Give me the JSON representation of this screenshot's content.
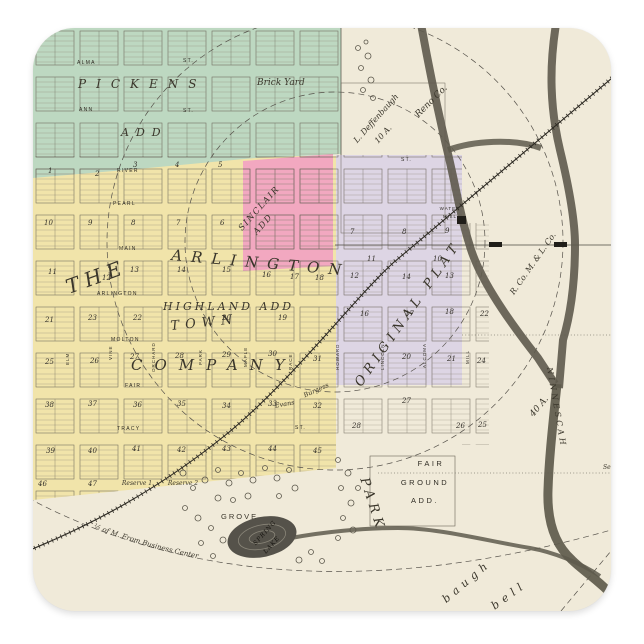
{
  "product": {
    "description_label": "square sticker with vintage town plat map"
  },
  "palette": {
    "paper": "#f0ead9",
    "green_addition": "#bdd8c1",
    "yellow_addition": "#f1e4aa",
    "pink_addition": "#f2a8c0",
    "lavender_addition": "#ddd5e4",
    "river": "#5e5a4c",
    "ink": "#3a362b",
    "page_background": "#ffffff"
  },
  "map": {
    "additions": {
      "pickens": "PICKENS",
      "pickens_add": "ADD",
      "sinclair": "SINCLAIR",
      "sinclair_add": "ADD",
      "original_plat": "ORIGINAL PLAT",
      "the": "THE",
      "arlington": "ARLINGTON",
      "town": "TOWN",
      "company": "COMPANY",
      "highland_add": "HIGHLAND ADD",
      "fair": "FAIR",
      "ground": "GROUND",
      "add": "ADD.",
      "park": "PARK"
    },
    "streets": {
      "alma": "ALMA",
      "ann": "ANN",
      "st": "ST.",
      "river": "RIVER",
      "pearl": "PEARL",
      "main": "MAIN",
      "arlington": "ARLINGTON",
      "molton": "MOLTON",
      "fair": "FAIR",
      "tracy": "TRACY",
      "elm": "ELM",
      "vine": "VINE",
      "orchard": "ORCHARD",
      "park": "PARK",
      "maple": "MAPLE",
      "race": "RACE",
      "howard": "HOWARD",
      "lincoln": "LINCOLN",
      "alcoma": "ALCOMA",
      "mill": "MILL"
    },
    "features": {
      "brick_yard": "Brick Yard",
      "water": "WATER",
      "mill": "MILL",
      "spring": "SPRING",
      "lake": "LAKE",
      "grove": "GROVE",
      "reserve1": "Reserve 1",
      "reserve2": "Reserve 2",
      "deffenbaugh": "L. Deffenbaugh",
      "ten_acres": "10 A.",
      "forty_acres": "40 A.",
      "reno_co": "Reno Co.",
      "mill_co": "R. Co. M. & L. Co.",
      "ninnescah": "NINNESCAH",
      "half_mile": "½ of M. From Business Center",
      "burgess": "Burgess",
      "evans": "Evans",
      "baugh": "baugh",
      "bell": "bell",
      "sec": "Sec."
    },
    "blocks": [
      {
        "n": "1",
        "x": 15,
        "y": 145
      },
      {
        "n": "2",
        "x": 62,
        "y": 148
      },
      {
        "n": "3",
        "x": 100,
        "y": 139
      },
      {
        "n": "4",
        "x": 142,
        "y": 139
      },
      {
        "n": "5",
        "x": 185,
        "y": 139
      },
      {
        "n": "10",
        "x": 11,
        "y": 197
      },
      {
        "n": "9",
        "x": 55,
        "y": 197
      },
      {
        "n": "8",
        "x": 98,
        "y": 197
      },
      {
        "n": "7",
        "x": 143,
        "y": 197
      },
      {
        "n": "6",
        "x": 187,
        "y": 197
      },
      {
        "n": "11",
        "x": 15,
        "y": 246
      },
      {
        "n": "12",
        "x": 69,
        "y": 252
      },
      {
        "n": "13",
        "x": 97,
        "y": 244
      },
      {
        "n": "14",
        "x": 144,
        "y": 244
      },
      {
        "n": "15",
        "x": 189,
        "y": 244
      },
      {
        "n": "16",
        "x": 229,
        "y": 249
      },
      {
        "n": "17",
        "x": 257,
        "y": 251
      },
      {
        "n": "18",
        "x": 282,
        "y": 252
      },
      {
        "n": "21",
        "x": 12,
        "y": 294
      },
      {
        "n": "23",
        "x": 55,
        "y": 292
      },
      {
        "n": "22",
        "x": 100,
        "y": 292
      },
      {
        "n": "20",
        "x": 189,
        "y": 292
      },
      {
        "n": "19",
        "x": 245,
        "y": 292
      },
      {
        "n": "25",
        "x": 12,
        "y": 336
      },
      {
        "n": "26",
        "x": 57,
        "y": 335
      },
      {
        "n": "27",
        "x": 97,
        "y": 331
      },
      {
        "n": "28",
        "x": 142,
        "y": 330
      },
      {
        "n": "29",
        "x": 189,
        "y": 329
      },
      {
        "n": "30",
        "x": 235,
        "y": 328
      },
      {
        "n": "31",
        "x": 280,
        "y": 333
      },
      {
        "n": "38",
        "x": 12,
        "y": 379
      },
      {
        "n": "37",
        "x": 55,
        "y": 378
      },
      {
        "n": "36",
        "x": 100,
        "y": 379
      },
      {
        "n": "35",
        "x": 144,
        "y": 378
      },
      {
        "n": "34",
        "x": 189,
        "y": 380
      },
      {
        "n": "33",
        "x": 235,
        "y": 378
      },
      {
        "n": "32",
        "x": 280,
        "y": 380
      },
      {
        "n": "39",
        "x": 13,
        "y": 425
      },
      {
        "n": "40",
        "x": 55,
        "y": 425
      },
      {
        "n": "41",
        "x": 99,
        "y": 423
      },
      {
        "n": "42",
        "x": 144,
        "y": 424
      },
      {
        "n": "43",
        "x": 189,
        "y": 423
      },
      {
        "n": "44",
        "x": 235,
        "y": 423
      },
      {
        "n": "45",
        "x": 280,
        "y": 425
      },
      {
        "n": "46",
        "x": 5,
        "y": 458
      },
      {
        "n": "47",
        "x": 55,
        "y": 458
      },
      {
        "n": "7",
        "x": 317,
        "y": 206
      },
      {
        "n": "8",
        "x": 369,
        "y": 206
      },
      {
        "n": "9",
        "x": 412,
        "y": 205
      },
      {
        "n": "11",
        "x": 334,
        "y": 233
      },
      {
        "n": "10",
        "x": 400,
        "y": 233
      },
      {
        "n": "12",
        "x": 317,
        "y": 250
      },
      {
        "n": "14",
        "x": 369,
        "y": 251
      },
      {
        "n": "13",
        "x": 412,
        "y": 250
      },
      {
        "n": "16",
        "x": 327,
        "y": 288
      },
      {
        "n": "17",
        "x": 372,
        "y": 288
      },
      {
        "n": "18",
        "x": 412,
        "y": 286
      },
      {
        "n": "22",
        "x": 447,
        "y": 288
      },
      {
        "n": "20",
        "x": 369,
        "y": 331
      },
      {
        "n": "21",
        "x": 414,
        "y": 333
      },
      {
        "n": "24",
        "x": 444,
        "y": 335
      },
      {
        "n": "27",
        "x": 369,
        "y": 375
      },
      {
        "n": "28",
        "x": 319,
        "y": 400
      },
      {
        "n": "26",
        "x": 423,
        "y": 400
      },
      {
        "n": "25",
        "x": 445,
        "y": 399
      }
    ]
  }
}
